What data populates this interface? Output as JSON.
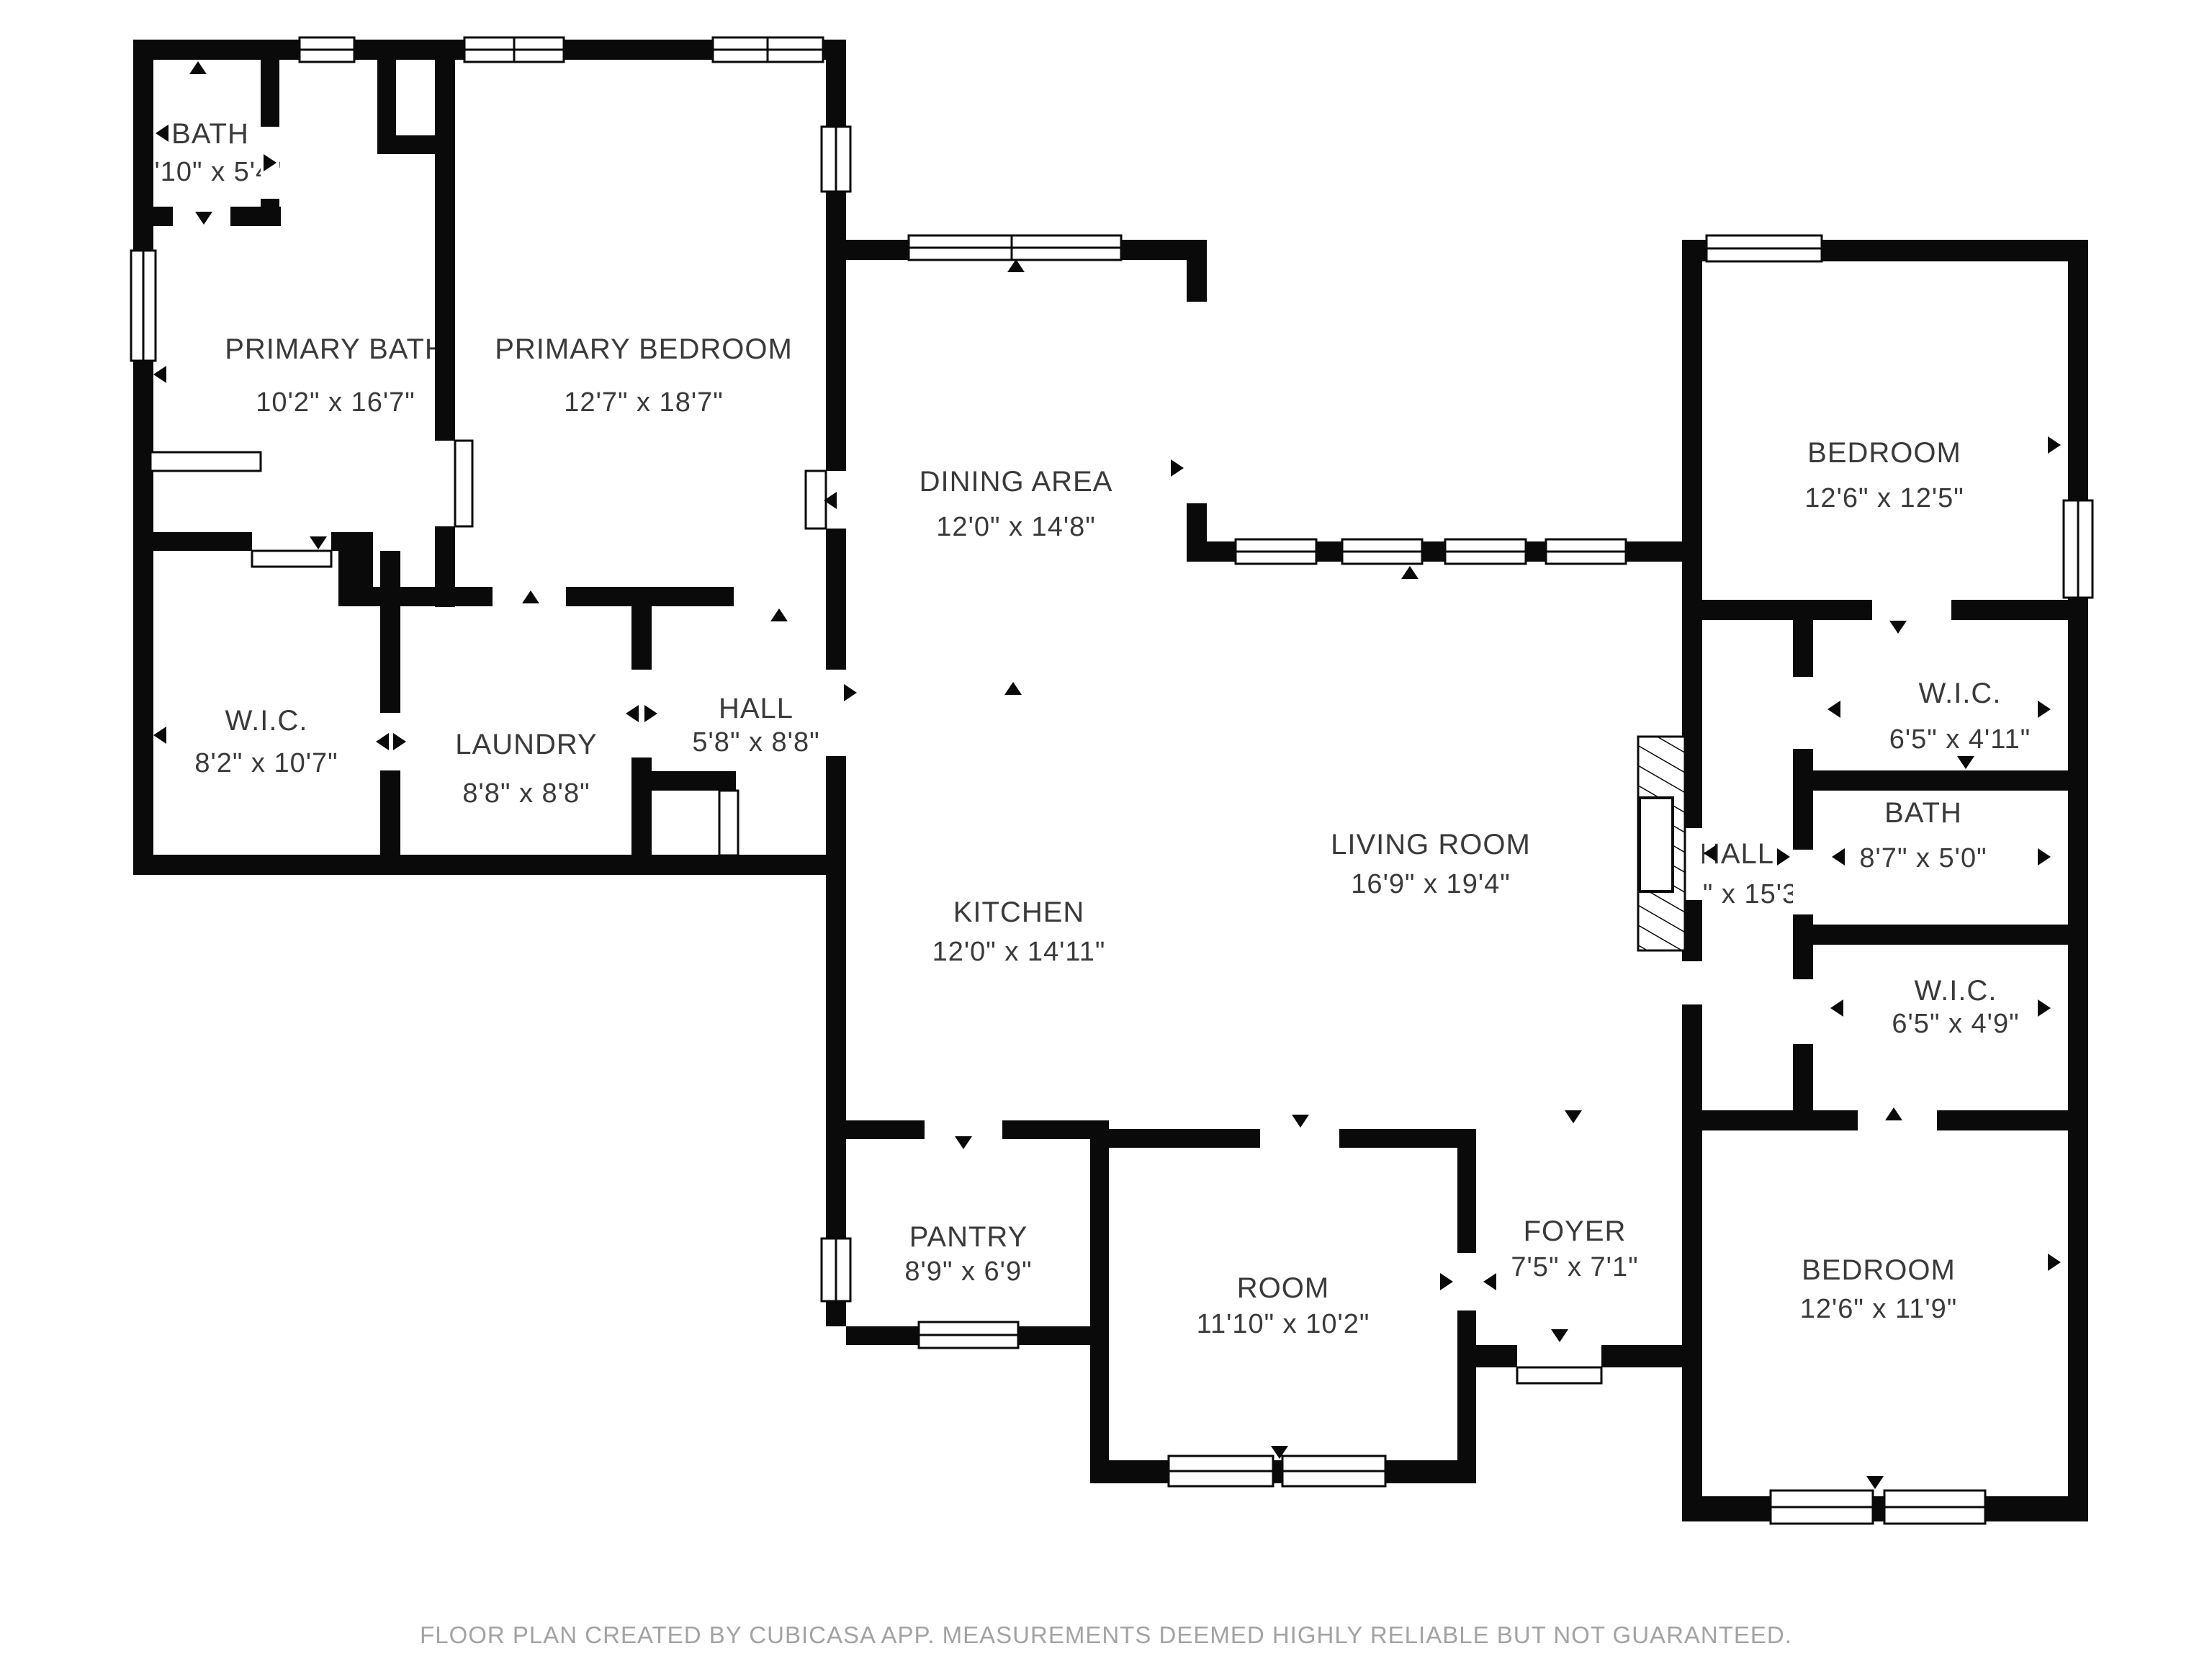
{
  "page": {
    "footer": "FLOOR PLAN CREATED BY CUBICASA APP. MEASUREMENTS DEEMED HIGHLY RELIABLE BUT NOT GUARANTEED."
  },
  "colors": {
    "wall": "#0a0a0a",
    "label": "#3a3a3a",
    "footer_gray": "#a3a3a3",
    "background": "#ffffff"
  },
  "rooms": [
    {
      "id": "bath-small",
      "name": "BATH",
      "dims": "3'10\" x 5'4\""
    },
    {
      "id": "primary-bath",
      "name": "PRIMARY BATH",
      "dims": "10'2\" x 16'7\""
    },
    {
      "id": "primary-bedroom",
      "name": "PRIMARY BEDROOM",
      "dims": "12'7\" x 18'7\""
    },
    {
      "id": "dining-area",
      "name": "DINING AREA",
      "dims": "12'0\" x 14'8\""
    },
    {
      "id": "bedroom-top-right",
      "name": "BEDROOM",
      "dims": "12'6\" x 12'5\""
    },
    {
      "id": "wic-left",
      "name": "W.I.C.",
      "dims": "8'2\" x 10'7\""
    },
    {
      "id": "laundry",
      "name": "LAUNDRY",
      "dims": "8'8\" x 8'8\""
    },
    {
      "id": "hall-left",
      "name": "HALL",
      "dims": "5'8\" x 8'8\""
    },
    {
      "id": "wic-right-upper",
      "name": "W.I.C.",
      "dims": "6'5\" x 4'11\""
    },
    {
      "id": "bath-right",
      "name": "BATH",
      "dims": "8'7\" x 5'0\""
    },
    {
      "id": "hall-right",
      "name": "HALL",
      "dims": "3'3\" x 15'3\""
    },
    {
      "id": "living-room",
      "name": "LIVING ROOM",
      "dims": "16'9\" x 19'4\""
    },
    {
      "id": "kitchen",
      "name": "KITCHEN",
      "dims": "12'0\" x 14'11\""
    },
    {
      "id": "wic-right-lower",
      "name": "W.I.C.",
      "dims": "6'5\" x 4'9\""
    },
    {
      "id": "pantry",
      "name": "PANTRY",
      "dims": "8'9\" x 6'9\""
    },
    {
      "id": "room",
      "name": "ROOM",
      "dims": "11'10\" x 10'2\""
    },
    {
      "id": "foyer",
      "name": "FOYER",
      "dims": "7'5\" x 7'1\""
    },
    {
      "id": "bedroom-bot-right",
      "name": "BEDROOM",
      "dims": "12'6\" x 11'9\""
    }
  ]
}
